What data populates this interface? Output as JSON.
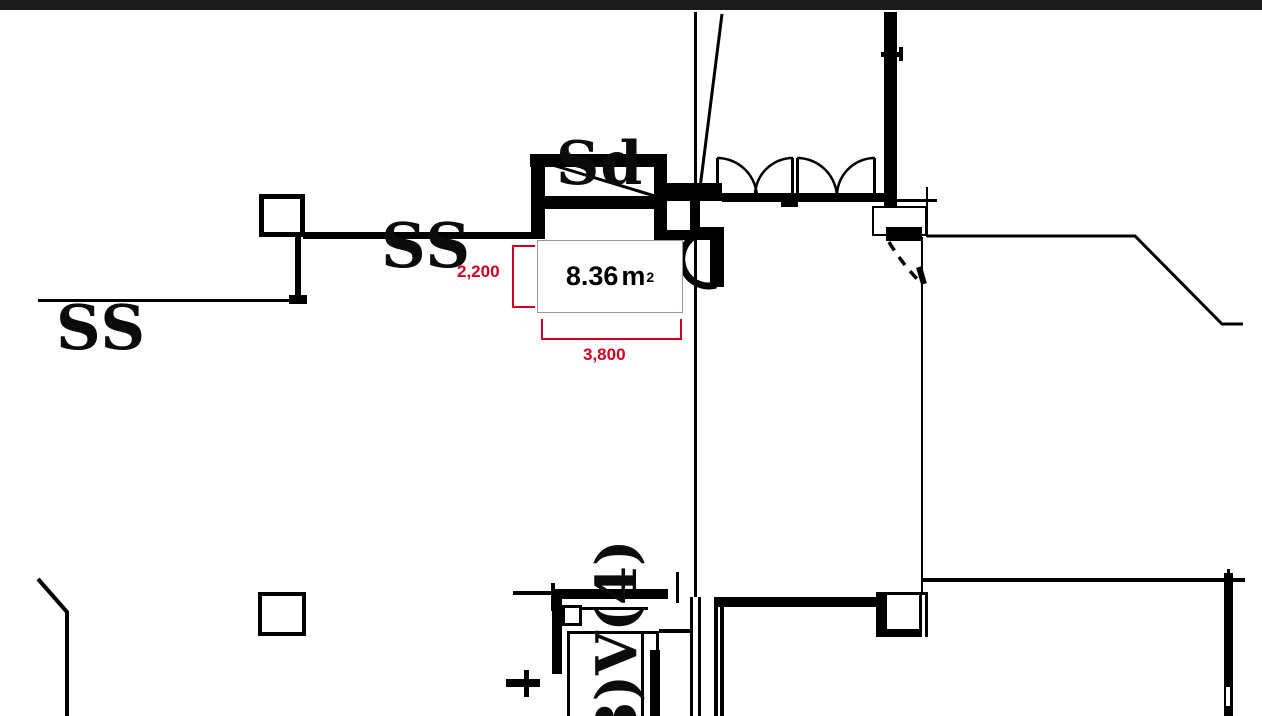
{
  "drawing": {
    "type": "architectural-floor-plan",
    "labels": {
      "shutter": "Sd",
      "ss_upper": "SS",
      "ss_lower": "SS",
      "rotated_ref": "3)V(4)"
    },
    "area": {
      "value": "8.36",
      "unit": "m",
      "unit_sup": "2"
    },
    "dimensions": {
      "room_height": "2,200",
      "room_width": "3,800"
    },
    "colors": {
      "line": "#000000",
      "dimension_red": "#cc0022",
      "top_bar": "#1b1b1b",
      "area_box_border": "#9a9a9a"
    }
  }
}
